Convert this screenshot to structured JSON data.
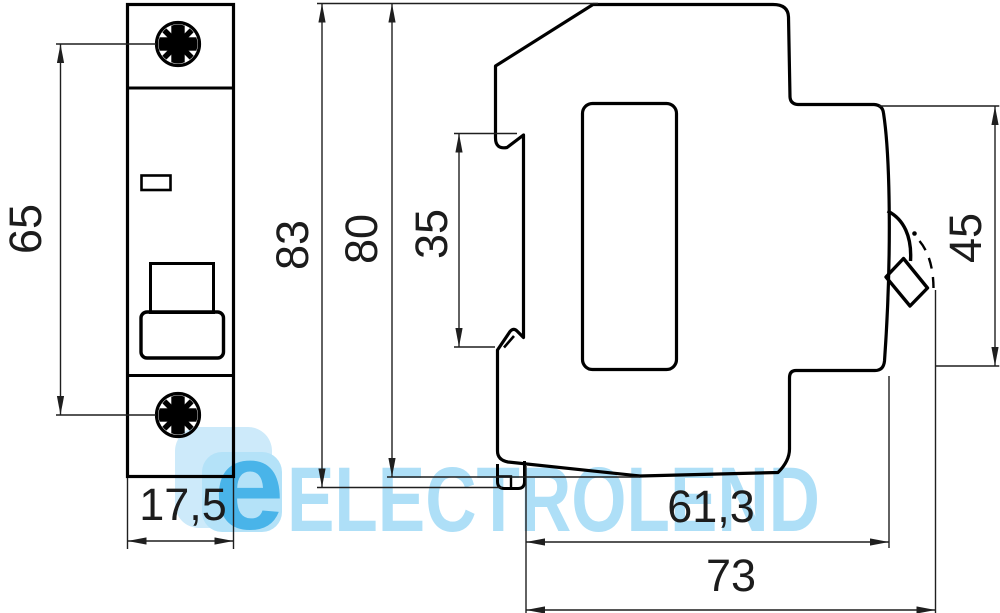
{
  "meta": {
    "drawing_type": "technical dimensional drawing",
    "subject": "1-pole modular circuit breaker outline, front and side views",
    "units": "mm"
  },
  "colors": {
    "background": "#ffffff",
    "outline": "#000000",
    "dimension_lines": "#1f1f1f",
    "watermark_text": "#aedff7",
    "watermark_logo_letter": "#49b4e9",
    "watermark_tile_back": "#cdeafa",
    "watermark_tile_front": "#b4e2f8"
  },
  "dim_labels": {
    "d65": "65",
    "d175": "17,5",
    "d83": "83",
    "d80": "80",
    "d35": "35",
    "d45": "45",
    "d613": "61,3",
    "d73": "73"
  },
  "views": {
    "front": {
      "name": "front view",
      "dimensions": [
        {
          "label": "65",
          "meaning": "distance between mounting screw centers"
        },
        {
          "label": "17,5",
          "meaning": "module width"
        }
      ]
    },
    "side": {
      "name": "side view",
      "dimensions": [
        {
          "label": "83",
          "meaning": "overall height with DIN clip tab"
        },
        {
          "label": "80",
          "meaning": "body height"
        },
        {
          "label": "35",
          "meaning": "DIN rail recess height"
        },
        {
          "label": "45",
          "meaning": "front face height"
        },
        {
          "label": "61,3",
          "meaning": "depth to front face"
        },
        {
          "label": "73",
          "meaning": "overall depth with lever"
        }
      ]
    }
  },
  "watermark": {
    "brand_text": "ELECTROLEND",
    "logo_letter": "e"
  }
}
